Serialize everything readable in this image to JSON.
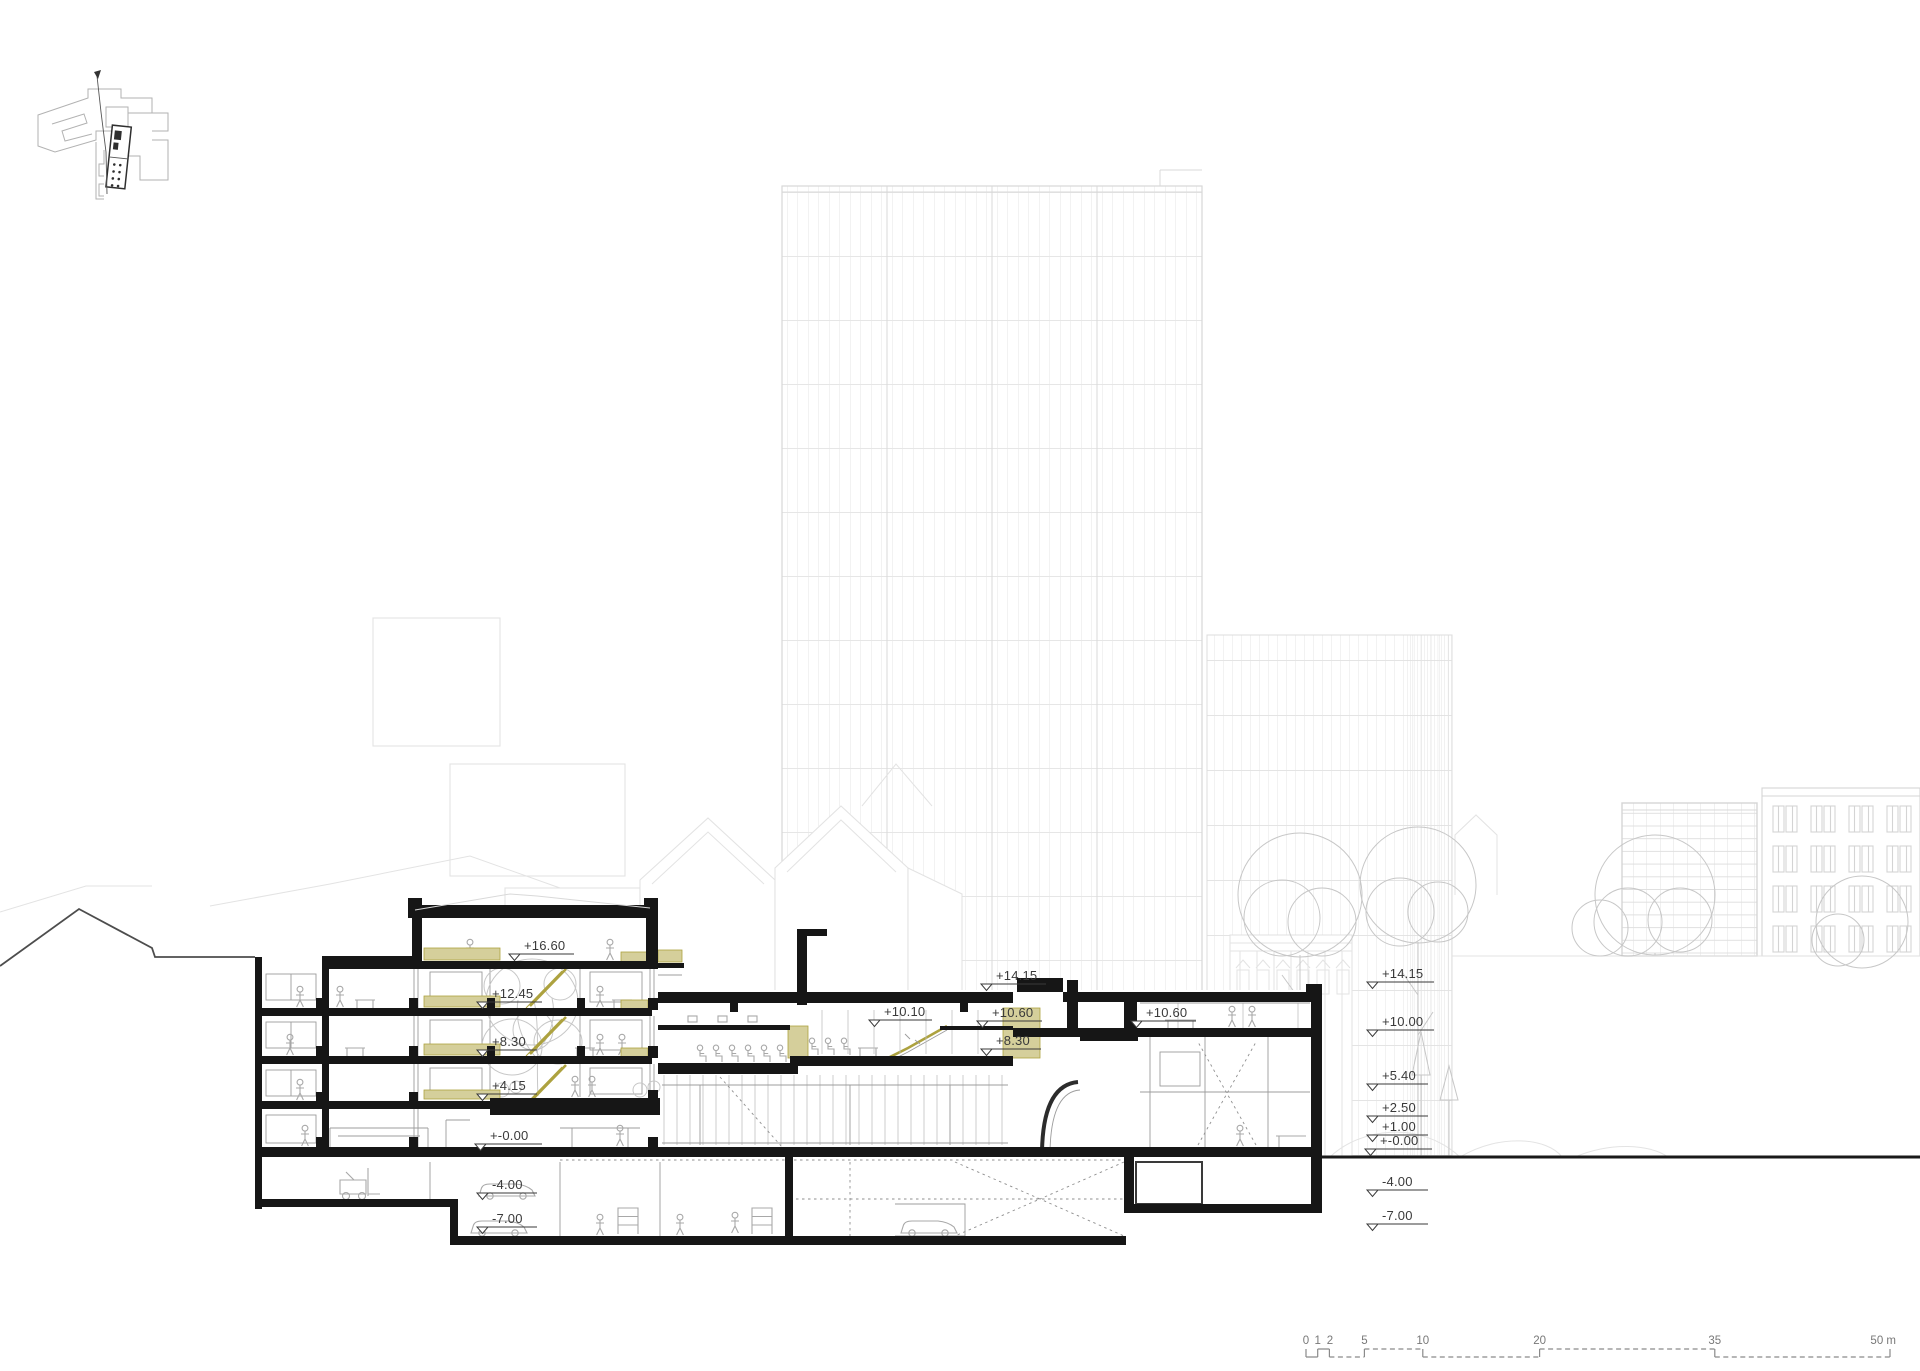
{
  "drawing": {
    "kind": "architectural long section with city context"
  },
  "elevation_markers": {
    "left": [
      {
        "label": "+16.60"
      },
      {
        "label": "+12.45"
      },
      {
        "label": "+8.30"
      },
      {
        "label": "+4.15"
      },
      {
        "label": "+-0.00"
      },
      {
        "label": "-4.00"
      },
      {
        "label": "-7.00"
      }
    ],
    "middle": [
      {
        "label": "+14.15"
      },
      {
        "label": "+10.60"
      },
      {
        "label": "+10.10"
      },
      {
        "label": "+8.30"
      },
      {
        "label": "+10.60"
      }
    ],
    "right": [
      {
        "label": "+14.15"
      },
      {
        "label": "+10.00"
      },
      {
        "label": "+5.40"
      },
      {
        "label": "+2.50"
      },
      {
        "label": "+1.00"
      },
      {
        "label": "+-0.00"
      },
      {
        "label": "-4.00"
      },
      {
        "label": "-7.00"
      }
    ]
  },
  "scale_bar": {
    "ticks": [
      "0",
      "1",
      "2",
      "5",
      "10",
      "20",
      "35"
    ],
    "end_label": "50 m"
  },
  "colors": {
    "section_black": "#161616",
    "accent_olive": "#ada23f",
    "accent_olive_fill": "#d5cf9b",
    "background_line": "#e3e3e3",
    "marker_text": "#3a3a3a"
  }
}
